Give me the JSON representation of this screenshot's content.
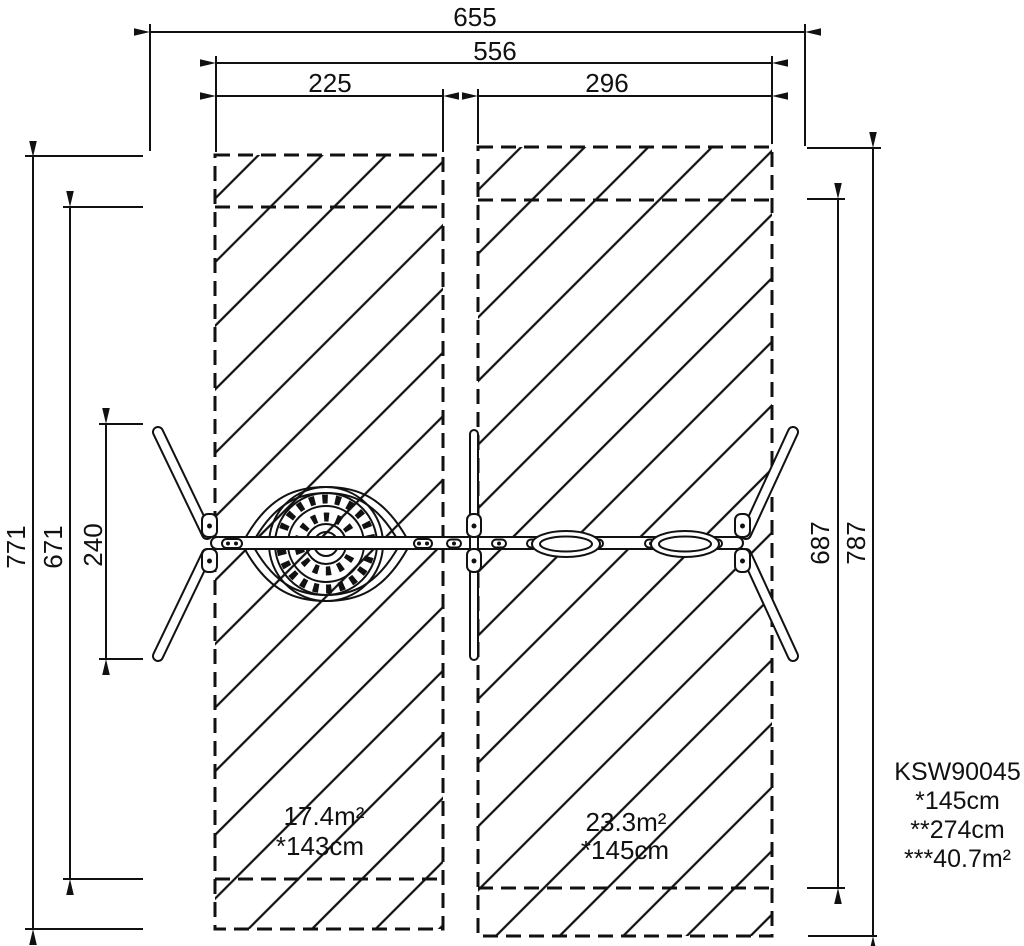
{
  "drawing": {
    "dims": {
      "overall_width": "655",
      "inner_width": "556",
      "left_zone_width": "225",
      "right_zone_width": "296",
      "left_outer_height": "771",
      "left_inner_height": "671",
      "frame_depth": "240",
      "right_inner_height": "687",
      "right_outer_height": "787"
    },
    "zones": {
      "left": {
        "area": "17.4m²",
        "height_note": "*143cm"
      },
      "right": {
        "area": "23.3m²",
        "height_note": "*145cm"
      }
    },
    "product": {
      "code": "KSW90045",
      "specs": [
        "*145cm",
        "**274cm",
        "***40.7m²"
      ]
    },
    "colors": {
      "line": "#111111",
      "background": "#ffffff"
    }
  }
}
